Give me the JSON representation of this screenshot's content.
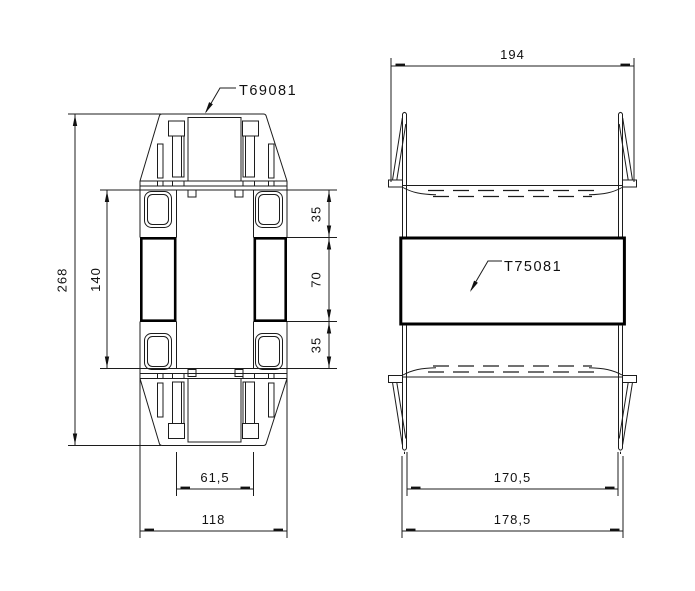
{
  "drawing": {
    "background_color": "#ffffff",
    "line_color": "#1a1a1a",
    "front_view": {
      "part_label": "T69081",
      "dim_overall_height": "268",
      "dim_inner_height": "140",
      "dim_top_window": "35",
      "dim_center_span": "70",
      "dim_bottom_window": "35",
      "dim_inner_width": "61,5",
      "dim_outer_width": "118"
    },
    "side_view": {
      "part_label": "T75081",
      "dim_flange_span": "194",
      "dim_inner_span": "170,5",
      "dim_outer_span": "178,5"
    }
  }
}
